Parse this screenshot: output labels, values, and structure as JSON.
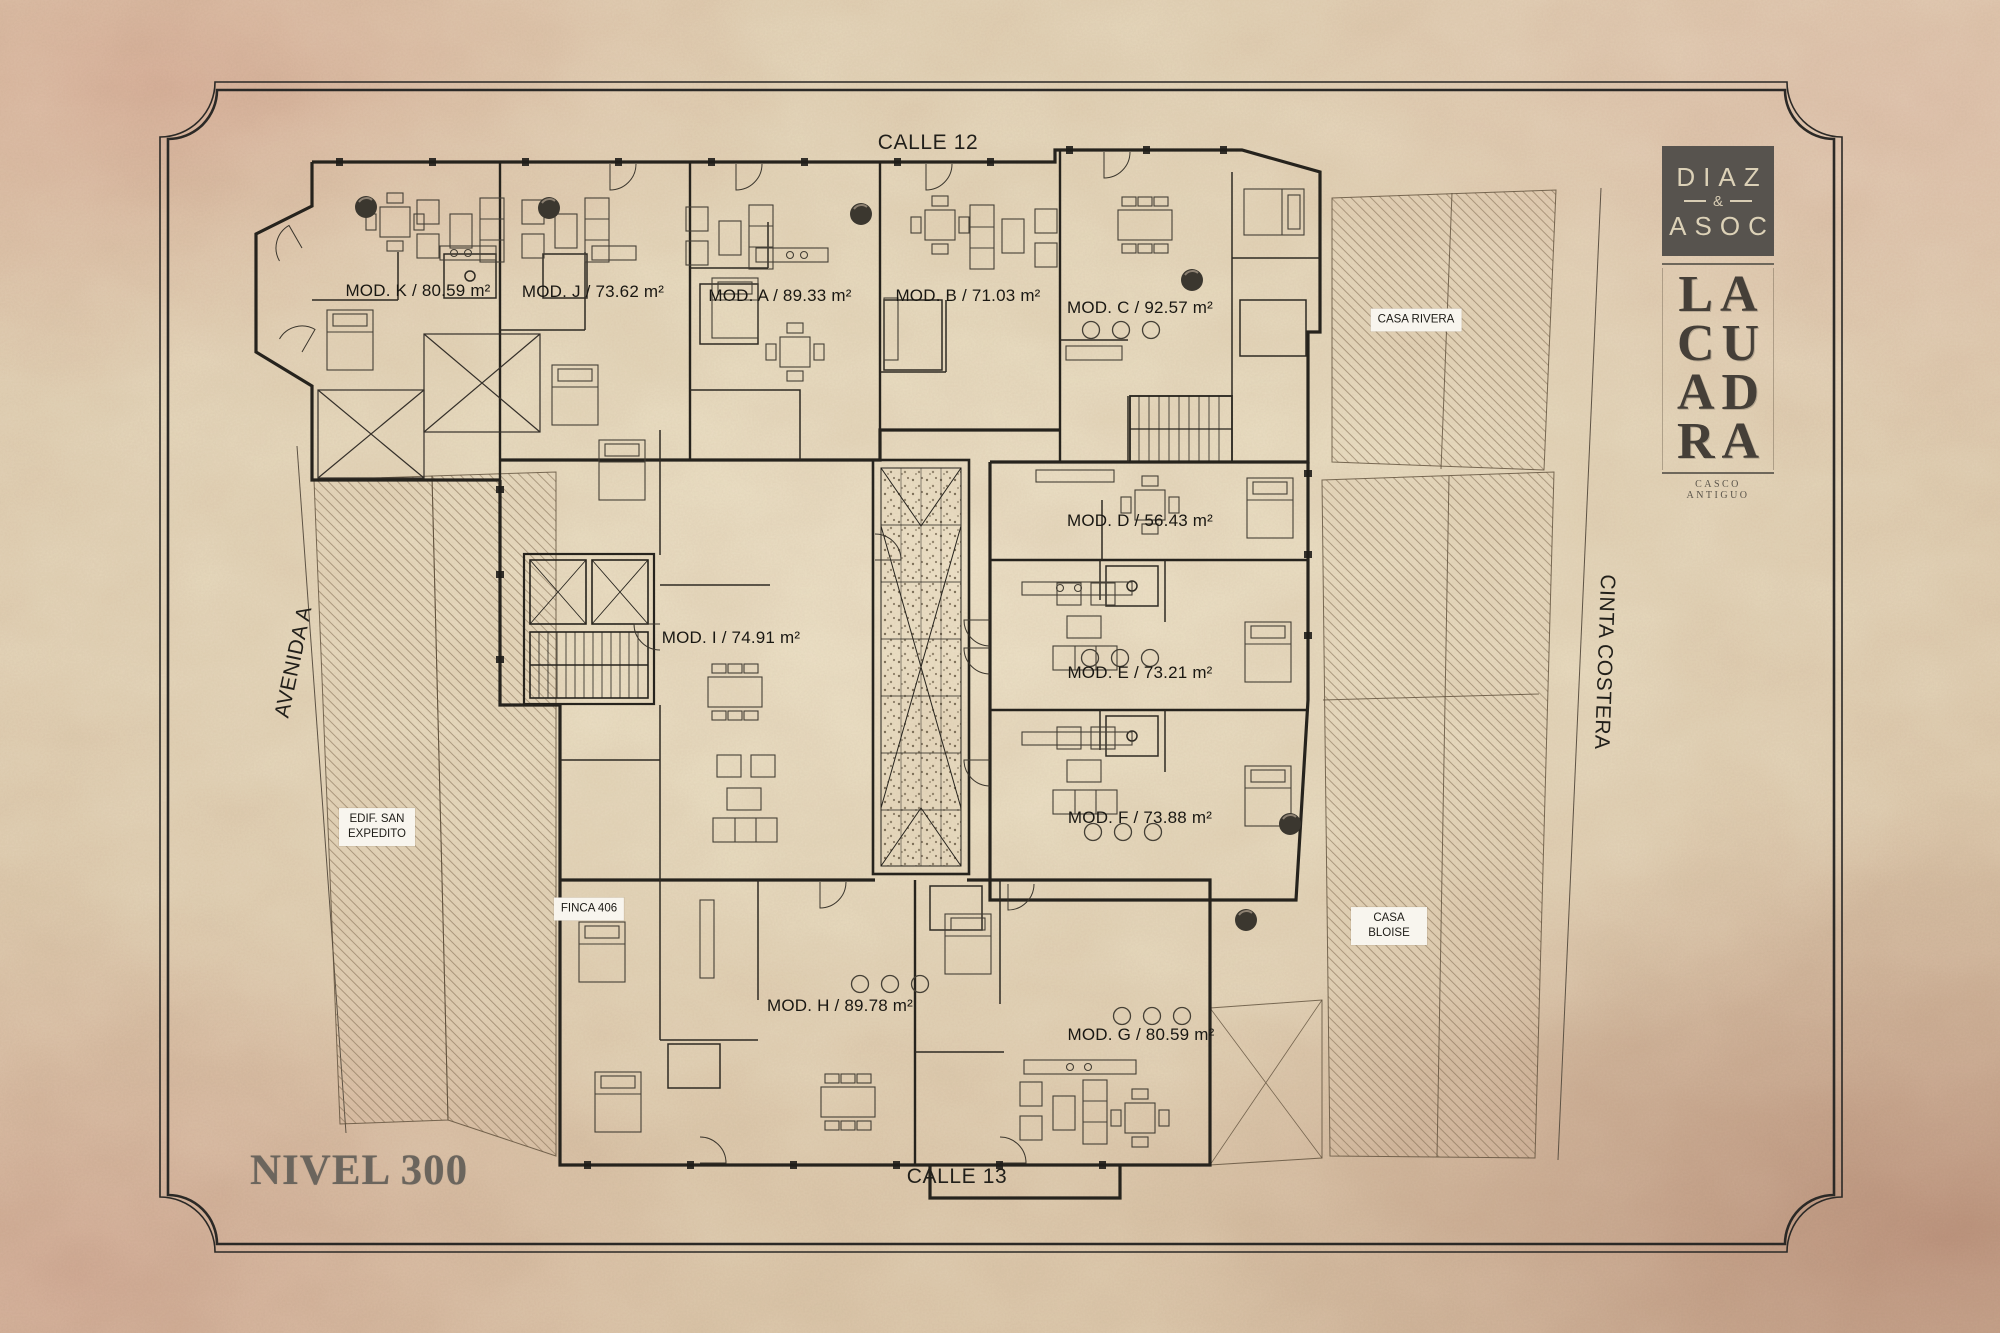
{
  "level_title": "NIVEL 300",
  "streets": {
    "top": "CALLE 12",
    "bottom": "CALLE 13",
    "left": "AVENIDA A",
    "right": "CINTA COSTERA"
  },
  "brand": {
    "firm_top": "DIAZ",
    "firm_amp": "&",
    "firm_bottom": "ASOC",
    "project_lines": [
      "LA",
      "CU",
      "AD",
      "RA"
    ],
    "project_subtitle": "CASCO ANTIGUO"
  },
  "modules": [
    {
      "id": "K",
      "area_m2": 80.59,
      "label": "MOD. K / 80.59 m²"
    },
    {
      "id": "J",
      "area_m2": 73.62,
      "label": "MOD. J / 73.62 m²"
    },
    {
      "id": "A",
      "area_m2": 89.33,
      "label": "MOD. A / 89.33 m²"
    },
    {
      "id": "B",
      "area_m2": 71.03,
      "label": "MOD. B / 71.03 m²"
    },
    {
      "id": "C",
      "area_m2": 92.57,
      "label": "MOD. C / 92.57 m²"
    },
    {
      "id": "D",
      "area_m2": 56.43,
      "label": "MOD. D / 56.43 m²"
    },
    {
      "id": "I",
      "area_m2": 74.91,
      "label": "MOD. I / 74.91 m²"
    },
    {
      "id": "E",
      "area_m2": 73.21,
      "label": "MOD. E / 73.21 m²"
    },
    {
      "id": "F",
      "area_m2": 73.88,
      "label": "MOD. F / 73.88 m²"
    },
    {
      "id": "H",
      "area_m2": 89.78,
      "label": "MOD. H / 89.78 m²"
    },
    {
      "id": "G",
      "area_m2": 80.59,
      "label": "MOD. G / 80.59 m²"
    }
  ],
  "neighbors": [
    {
      "name": "CASA RIVERA"
    },
    {
      "name": "EDIF. SAN EXPEDITO"
    },
    {
      "name": "FINCA 406"
    },
    {
      "name": "CASA BLOISE"
    }
  ],
  "colors": {
    "paper": "#ebdfc4",
    "edge_tint": "#c99c8a",
    "ink": "#26231d",
    "logo_box": "#57534e",
    "logo_text": "#dcd1b7",
    "muted_ink": "#6b655d",
    "label_bg": "#f8f5ee"
  }
}
